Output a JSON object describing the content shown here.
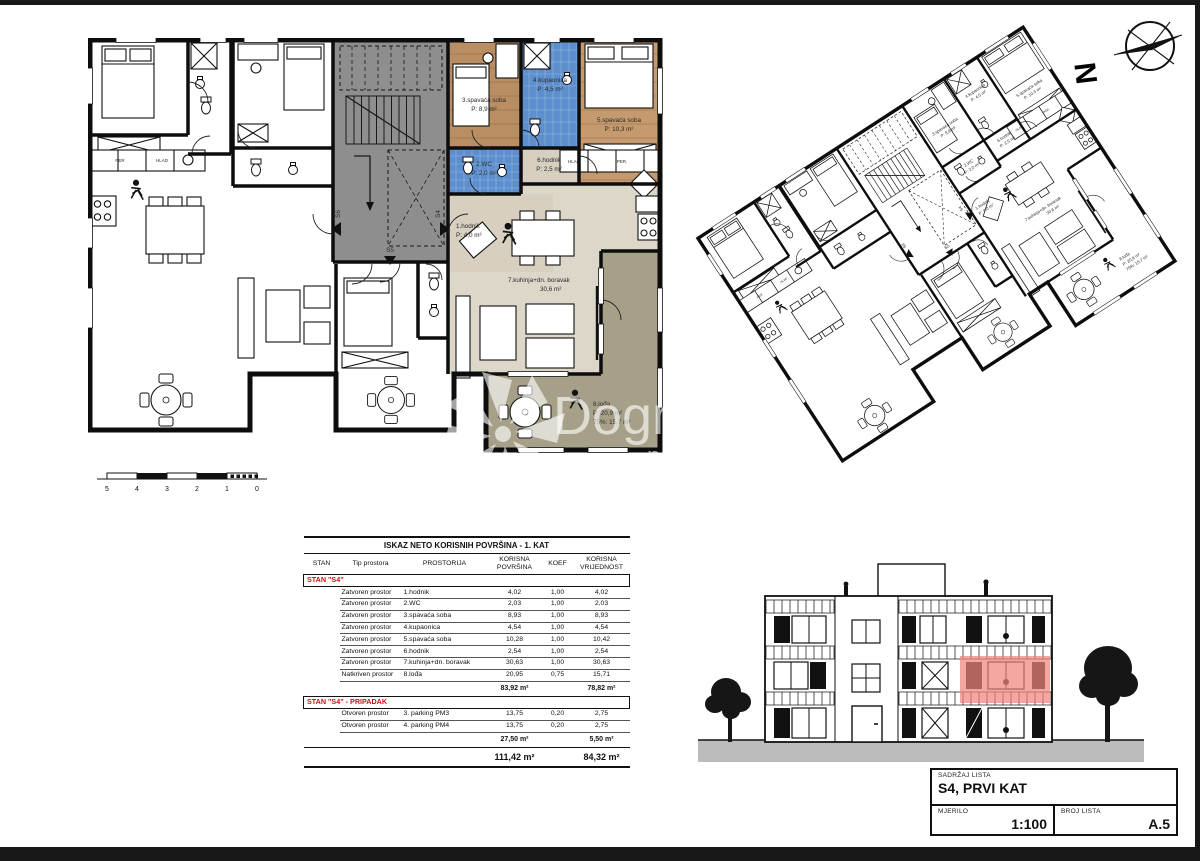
{
  "page": {
    "background": "#ffffff",
    "frame_color": "#181818"
  },
  "colors": {
    "accent_red": "#cc1111",
    "elevation_highlight": "#f0837c",
    "wood_floor": "#b98e63",
    "tile_blue": "#5d8fce",
    "hall_beige": "#d7cfc0",
    "living_beige": "#ddd7c9",
    "loggia_olive": "#a7a089",
    "stair_gray": "#8e8e8e",
    "ground_gray": "#bcbcbc"
  },
  "north": {
    "label": "N"
  },
  "watermark": {
    "brand": "Dogma",
    "subtitle": "nekretnine"
  },
  "floor_plan": {
    "rooms": [
      {
        "name": "1.hodnik",
        "area": "P: 4,0 m²"
      },
      {
        "name": "2.WC",
        "area": "P: 2,0 m²"
      },
      {
        "name": "3.spavaća soba",
        "area": "P: 8,9 m²"
      },
      {
        "name": "4.kupaonica",
        "area": "P: 4,5 m²"
      },
      {
        "name": "5.spavaća soba",
        "area": "P: 10,3 m²"
      },
      {
        "name": "6.hodnik",
        "area": "P: 2,5 m²"
      },
      {
        "name": "7.kuhinja+dn. boravak",
        "area": "30,6 m²"
      },
      {
        "name": "8.lođa",
        "area": "P: 20,9 m²",
        "area2": "75%: 15,7 m²"
      }
    ],
    "stairwell": {
      "door_labels": [
        "S6",
        "S5",
        "S4"
      ]
    },
    "kitchen_cabinet_labels": {
      "s4": [
        "HLAD",
        "PER."
      ],
      "left": [
        "PER",
        "HLAD"
      ]
    },
    "scale_bar": {
      "numbers": [
        "5",
        "4",
        "3",
        "2",
        "1",
        "0"
      ]
    }
  },
  "table": {
    "title": "ISKAZ NETO KORISNIH POVRŠINA - 1. KAT",
    "columns": [
      "STAN",
      "Tip prostora",
      "PROSTORIJA",
      "KORISNA POVRŠINA",
      "KOEF",
      "KORISNA VRIJEDNOST"
    ],
    "sections": [
      {
        "header": "STAN \"S4\"",
        "rows": [
          [
            "Zatvoren prostor",
            "1.hodnik",
            "4,02",
            "1,00",
            "4,02"
          ],
          [
            "Zatvoren prostor",
            "2.WC",
            "2,03",
            "1,00",
            "2,03"
          ],
          [
            "Zatvoren prostor",
            "3.spavaća soba",
            "8,93",
            "1,00",
            "8,93"
          ],
          [
            "Zatvoren prostor",
            "4.kupaonica",
            "4,54",
            "1,00",
            "4,54"
          ],
          [
            "Zatvoren prostor",
            "5.spavaća soba",
            "10,28",
            "1,00",
            "10,42"
          ],
          [
            "Zatvoren prostor",
            "6.hodnik",
            "2,54",
            "1,00",
            "2,54"
          ],
          [
            "Zatvoren prostor",
            "7.kuhinja+dn. boravak",
            "30,63",
            "1,00",
            "30,63"
          ],
          [
            "Natkriven prostor",
            "8.lođa",
            "20,95",
            "0,75",
            "15,71"
          ]
        ],
        "subtotal_povrsina": "83,92 m²",
        "subtotal_vrijednost": "78,82 m²"
      },
      {
        "header": "STAN \"S4\" - PRIPADAK",
        "rows": [
          [
            "Otvoren prostor",
            "3. parking PM3",
            "13,75",
            "0,20",
            "2,75"
          ],
          [
            "Otvoren prostor",
            "4. parking PM4",
            "13,75",
            "0,20",
            "2,75"
          ]
        ],
        "subtotal_povrsina": "27,50 m²",
        "subtotal_vrijednost": "5,50 m²"
      }
    ],
    "total_povrsina": "111,42 m²",
    "total_vrijednost": "84,32 m²"
  },
  "title_block": {
    "content_label": "SADRŽAJ LISTA",
    "content_value": "S4, PRVI KAT",
    "scale_label": "MJERILO",
    "scale_value": "1:100",
    "sheet_label": "BROJ LISTA",
    "sheet_value": "A.5"
  }
}
